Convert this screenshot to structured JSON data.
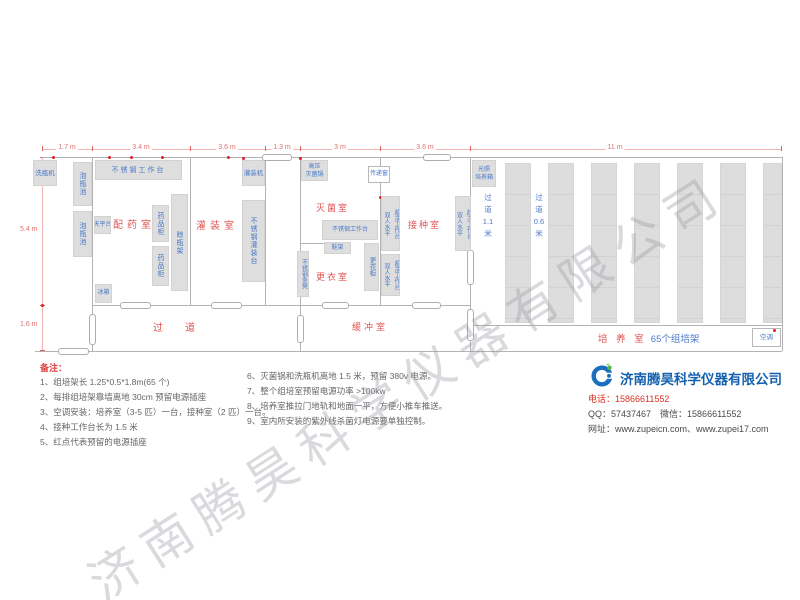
{
  "watermark": "济南腾昊科学仪器有限公司",
  "colors": {
    "room_label_red": "#e05555",
    "equipment_blue": "#4a79c8",
    "dimension_red": "#e07070",
    "outlet_dot_red": "#e02020",
    "block_gray": "#dedede",
    "wall_gray": "#b3b3b3",
    "company_blue": "#1661ae",
    "watermark_gray": "#9aa0a8"
  },
  "diagram": {
    "dims_top": [
      "1.7 m",
      "3.4 m",
      "3.6 m",
      "1.3 m",
      "3 m",
      "3.6 m",
      "11 m"
    ],
    "dims_left": [
      "5.4 m",
      "1.6 m"
    ],
    "rooms": {
      "medicine_prep": "配药室",
      "filling": "灌装室",
      "sterilization": "灭菌室",
      "changing": "更衣室",
      "inoculation": "接种室",
      "corridor": "过道",
      "buffer": "缓冲室",
      "culture": "培 养 室",
      "culture_racks": "65个组培架"
    },
    "aisles": {
      "a1": "过 道 1.1 米",
      "a2": "过 道 0.6 米"
    },
    "equipment": {
      "bottle_washer": "洗瓶机",
      "soaking_pool": "泡瓶池",
      "ss_workbench": "不锈钢工作台",
      "balance_table": "天平台",
      "medicine_cabinet": "药品柜",
      "bottle_rack": "晾瓶架",
      "fridge": "冰箱",
      "filling_machine": "灌装机",
      "ss_filling_table": "不锈钢灌装台",
      "autoclave": "高压 灭菌锅",
      "pass_window": "传递窗",
      "shoe_rack": "鞋架",
      "locker": "更衣柜",
      "ss_bench": "不锈钢条凳",
      "clean_bench_col1": "双人水平",
      "clean_bench_col2": "超净工作台",
      "light_incubator": "光照 培养箱",
      "air_conditioner": "空调"
    }
  },
  "notes": {
    "title": "备注：",
    "left": [
      "1、组培架长 1.25*0.5*1.8m(65 个)",
      "2、每排组培架靠墙离地 30cm 预留电源插座",
      "3、空调安装：培养室（3-5 匹）一台，接种室（2 匹）一台。",
      "4、接种工作台长为 1.5 米",
      "5、红点代表预留的电源插座"
    ],
    "right": [
      "6、灭菌锅和洗瓶机离地 1.5 米，预留 380v 电源。",
      "7、整个组培室预留电源功率 >100kw",
      "8、培养室推拉门地轨和地面一平，方便小推车推送。",
      "9、室内所安装的紫外线杀菌灯电源要单独控制。"
    ]
  },
  "company": {
    "logo_icon": "swirl-logo",
    "name": "济南腾昊科学仪器有限公司",
    "phone": "电话：15866611552",
    "qq_wechat": "QQ：57437467　微信：15866611552",
    "website": "网址：www.zupeicn.com、www.zupei17.com"
  }
}
